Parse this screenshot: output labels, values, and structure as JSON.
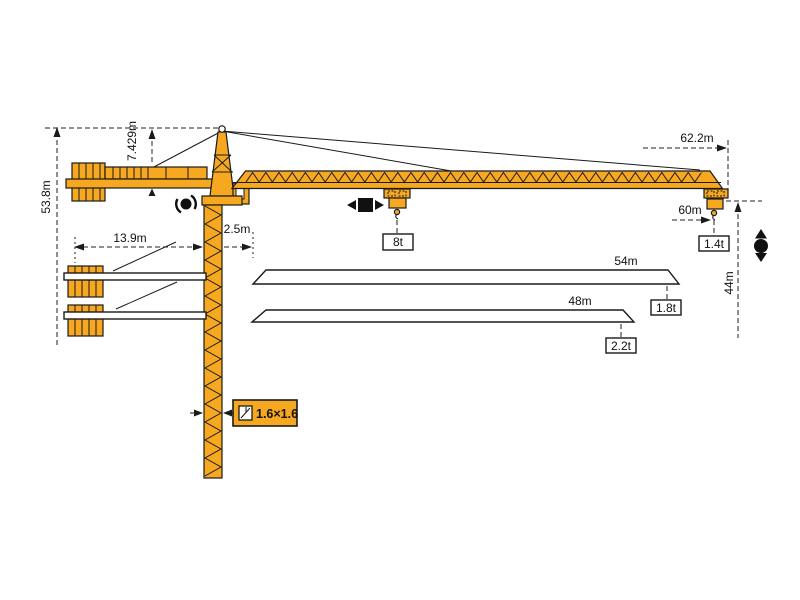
{
  "diagram": {
    "type": "tower-crane-specification-diagram",
    "colors": {
      "crane_orange": "#F6A821",
      "line_black": "#1a1a1a",
      "background": "#ffffff"
    },
    "labels": {
      "total_height": "53.8m",
      "head_height": "7.429m",
      "counterjib_radius": "13.9m",
      "pivot_offset": "2.5m",
      "max_radius": "62.2m",
      "main_jib_length": "60m",
      "max_capacity": "8t",
      "tip_load_60m": "1.4t",
      "hook_height": "44m",
      "jib_variant_54": "54m",
      "tip_load_54m": "1.8t",
      "jib_variant_48": "48m",
      "tip_load_48m": "2.2t",
      "mast_section": "1.6×1.6"
    },
    "icons": {
      "slewing": "slewing-rotation-icon",
      "trolley": "trolley-travel-icon",
      "hoist": "hoist-up-down-icon",
      "mast_section": "mast-cross-section-icon"
    }
  }
}
